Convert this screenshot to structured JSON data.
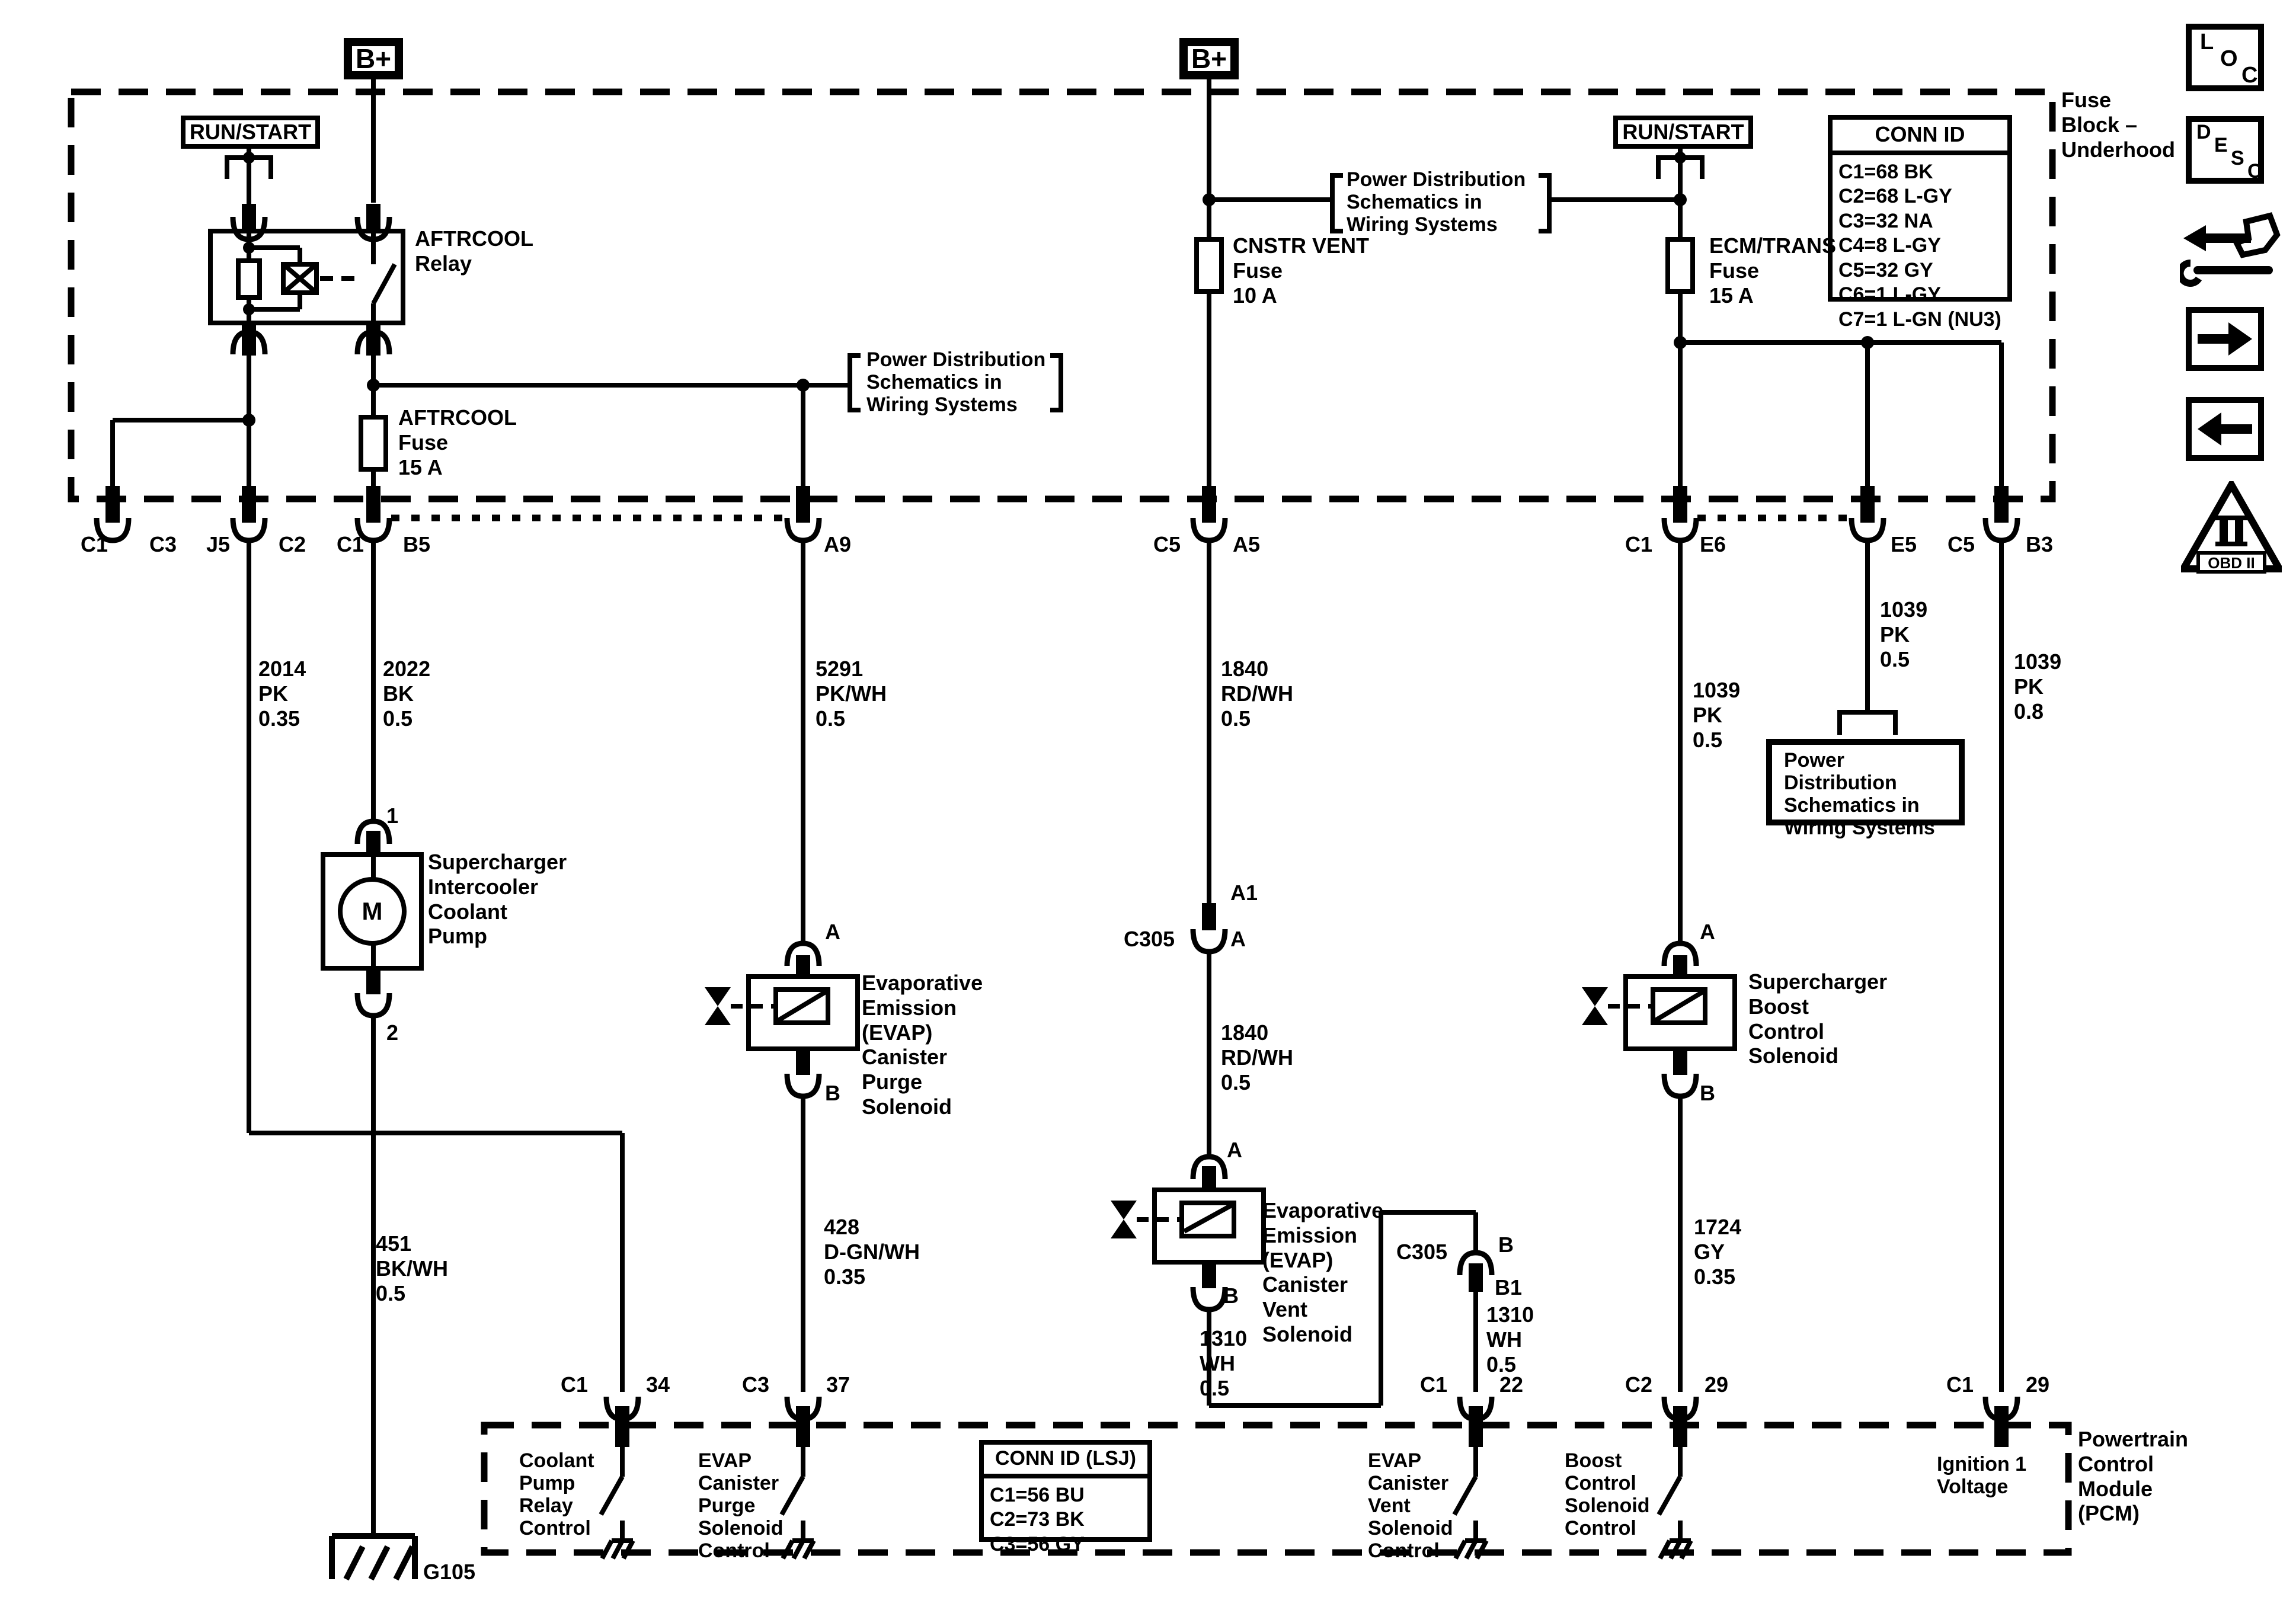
{
  "fuse_block": {
    "label": "Fuse\nBlock –\nUnderhood",
    "b_plus_left": "B+",
    "b_plus_middle": "B+",
    "run_start_left": "RUN/START",
    "run_start_right": "RUN/START",
    "aftrcool_relay": "AFTRCOOL\nRelay",
    "aftrcool_fuse": "AFTRCOOL\nFuse\n15 A",
    "cnstr_vent_fuse": "CNSTR VENT\nFuse\n10 A",
    "ecm_trans_fuse": "ECM/TRANS\nFuse\n15 A",
    "conn_id": {
      "title": "CONN ID",
      "rows": [
        "C1=68 BK",
        "C2=68 L-GY",
        "C3=32 NA",
        "C4=8 L-GY",
        "C5=32 GY",
        "C6=1 L-GY",
        "C7=1 L-GN (NU3)"
      ]
    }
  },
  "references": {
    "left": "Power Distribution\nSchematics in\nWiring Systems",
    "middle": "Power Distribution\nSchematics in\nWiring Systems",
    "right_box": "Power Distribution\nSchematics in\nWiring Systems"
  },
  "connectors": {
    "fb": [
      "C1",
      "C3",
      "J5",
      "C2",
      "C1",
      "B5",
      "A9",
      "C5",
      "A5",
      "C1",
      "E6",
      "E5",
      "C5",
      "B3"
    ],
    "c305_a": {
      "name": "C305",
      "upper": "A1",
      "lower": "A"
    },
    "c305_b": {
      "name": "C305",
      "upper": "B",
      "lower": "B1"
    }
  },
  "wires": {
    "w2014": "2014\nPK\n0.35",
    "w2022": "2022\nBK\n0.5",
    "w5291": "5291\nPK/WH\n0.5",
    "w1840_upper": "1840\nRD/WH\n0.5",
    "w1840_lower": "1840\nRD/WH\n0.5",
    "w1039_e6": "1039\nPK\n0.5",
    "w1039_e5": "1039\nPK\n0.5",
    "w1039_b3": "1039\nPK\n0.8",
    "w428": "428\nD-GN/WH\n0.35",
    "w1724": "1724\nGY\n0.35",
    "w1310_left": "1310\nWH\n0.5",
    "w1310_right": "1310\nWH\n0.5",
    "w451": "451\nBK/WH\n0.5"
  },
  "components": {
    "pump": {
      "label": "Supercharger\nIntercooler\nCoolant\nPump",
      "motor": "M",
      "pin1": "1",
      "pin2": "2"
    },
    "purge": {
      "label": "Evaporative\nEmission\n(EVAP)\nCanister\nPurge\nSolenoid",
      "pinA": "A",
      "pinB": "B"
    },
    "vent": {
      "label": "Evaporative\nEmission\n(EVAP)\nCanister\nVent\nSolenoid",
      "pinA": "A",
      "pinB": "B"
    },
    "boost": {
      "label": "Supercharger\nBoost\nControl\nSolenoid",
      "pinA": "A",
      "pinB": "B"
    }
  },
  "ground": {
    "label": "G105"
  },
  "pcm": {
    "label": "Powertrain\nControl\nModule\n(PCM)",
    "conn_id": {
      "title": "CONN ID (LSJ)",
      "rows": [
        "C1=56 BU",
        "C2=73 BK",
        "C3=56 GY"
      ]
    },
    "pins": [
      {
        "conn": "C1",
        "pin": "34",
        "label": "Coolant\nPump\nRelay\nControl"
      },
      {
        "conn": "C3",
        "pin": "37",
        "label": "EVAP\nCanister\nPurge\nSolenoid\nControl"
      },
      {
        "conn": "C1",
        "pin": "22",
        "label": "EVAP\nCanister\nVent\nSolenoid\nControl"
      },
      {
        "conn": "C2",
        "pin": "29",
        "label": "Boost\nControl\nSolenoid\nControl"
      },
      {
        "conn": "C1",
        "pin": "29",
        "label": "Ignition 1\nVoltage"
      }
    ]
  },
  "icons": {
    "loc": [
      "L",
      "O",
      "C"
    ],
    "desc": [
      "D",
      "E",
      "S",
      "C"
    ],
    "obd_label": "OBD II"
  }
}
